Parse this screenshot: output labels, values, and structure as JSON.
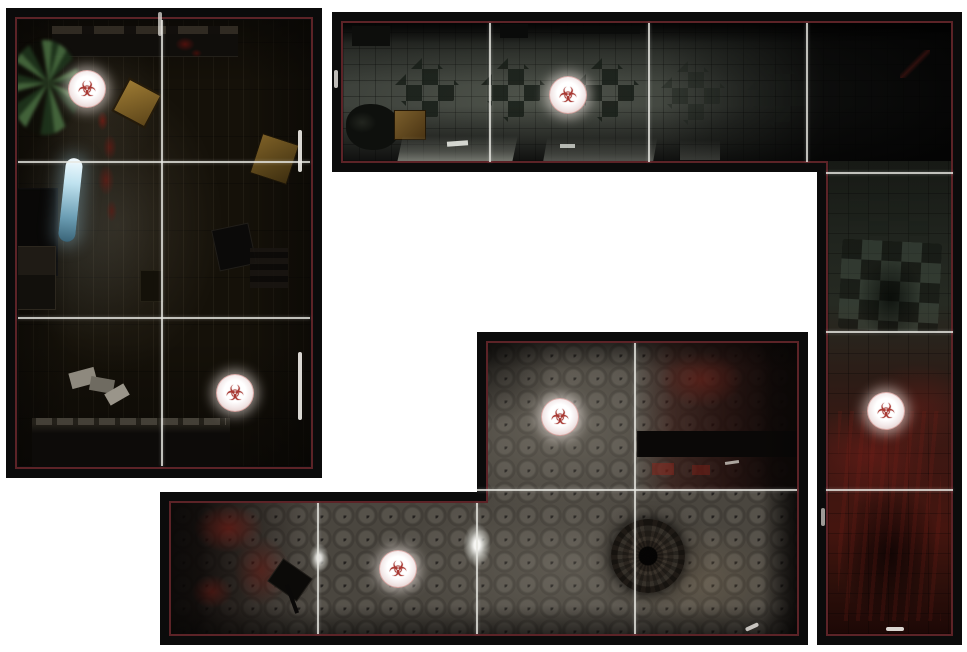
{
  "scene": {
    "type": "zombie-game-map-tiles",
    "background_color": "#ffffff",
    "tiles": [
      {
        "name": "dark-room-tile"
      },
      {
        "name": "corridor-l-tile"
      },
      {
        "name": "hallway-z-tile"
      }
    ],
    "token_count": 6
  },
  "colors": {
    "tile_border": "#0b0b0b",
    "inner_line": "#5c2327",
    "grid_line": "#e8e8e2",
    "token_background": "#f7efec",
    "token_symbol_color": "#a93832"
  },
  "tokens": [
    {
      "symbol": "☣"
    },
    {
      "symbol": "☣"
    },
    {
      "symbol": "☣"
    },
    {
      "symbol": "☣"
    },
    {
      "symbol": "☣"
    },
    {
      "symbol": "☣"
    }
  ]
}
